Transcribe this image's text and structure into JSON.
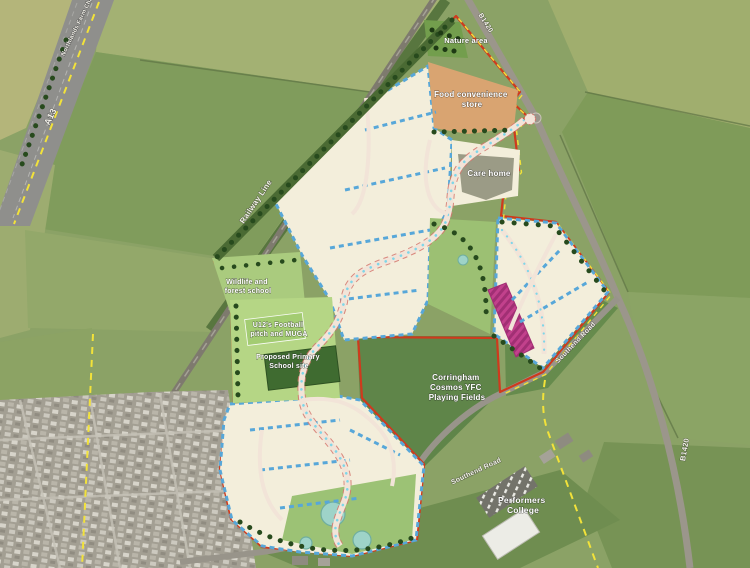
{
  "map": {
    "site_labels": {
      "nature_area": "Nature area",
      "food_store": [
        "Food convenience",
        "store"
      ],
      "care_home": "Care home",
      "wildlife": [
        "Wildlife and",
        "forest school"
      ],
      "football_pitch": [
        "U12's Football",
        "pitch and MUGA"
      ],
      "primary_school": [
        "Proposed Primary",
        "School site"
      ],
      "playing_fields": [
        "Corringham",
        "Cosmos YFC",
        "Playing Fields"
      ],
      "college": [
        "Performers",
        "College"
      ]
    },
    "road_labels": {
      "a13": "A13",
      "b1420_north": "B1420",
      "b1420_south": "B1420",
      "southend_road_east": "Southend Road",
      "southend_road_south": "Southend Road",
      "railway": "Railway Line",
      "farm_chase": "Northlands Farm Chase"
    },
    "colors": {
      "site_boundary_red": "#cf3a1d",
      "ownership_boundary_yellow": "#f2e23a",
      "residential_parcel_cream": "#f3eedb",
      "housing_frontage_blue": "#57a7d9",
      "convenience_store_orange": "#d9a471",
      "care_home_grey": "#9b9b86",
      "school_site_green": "#b5d685",
      "open_space_green": "#9cc073",
      "special_use_pink": "#c2418c",
      "pond_teal": "#9ed3c8",
      "tree_green": "#274a1d",
      "playing_field_green": "#5f8549"
    }
  }
}
